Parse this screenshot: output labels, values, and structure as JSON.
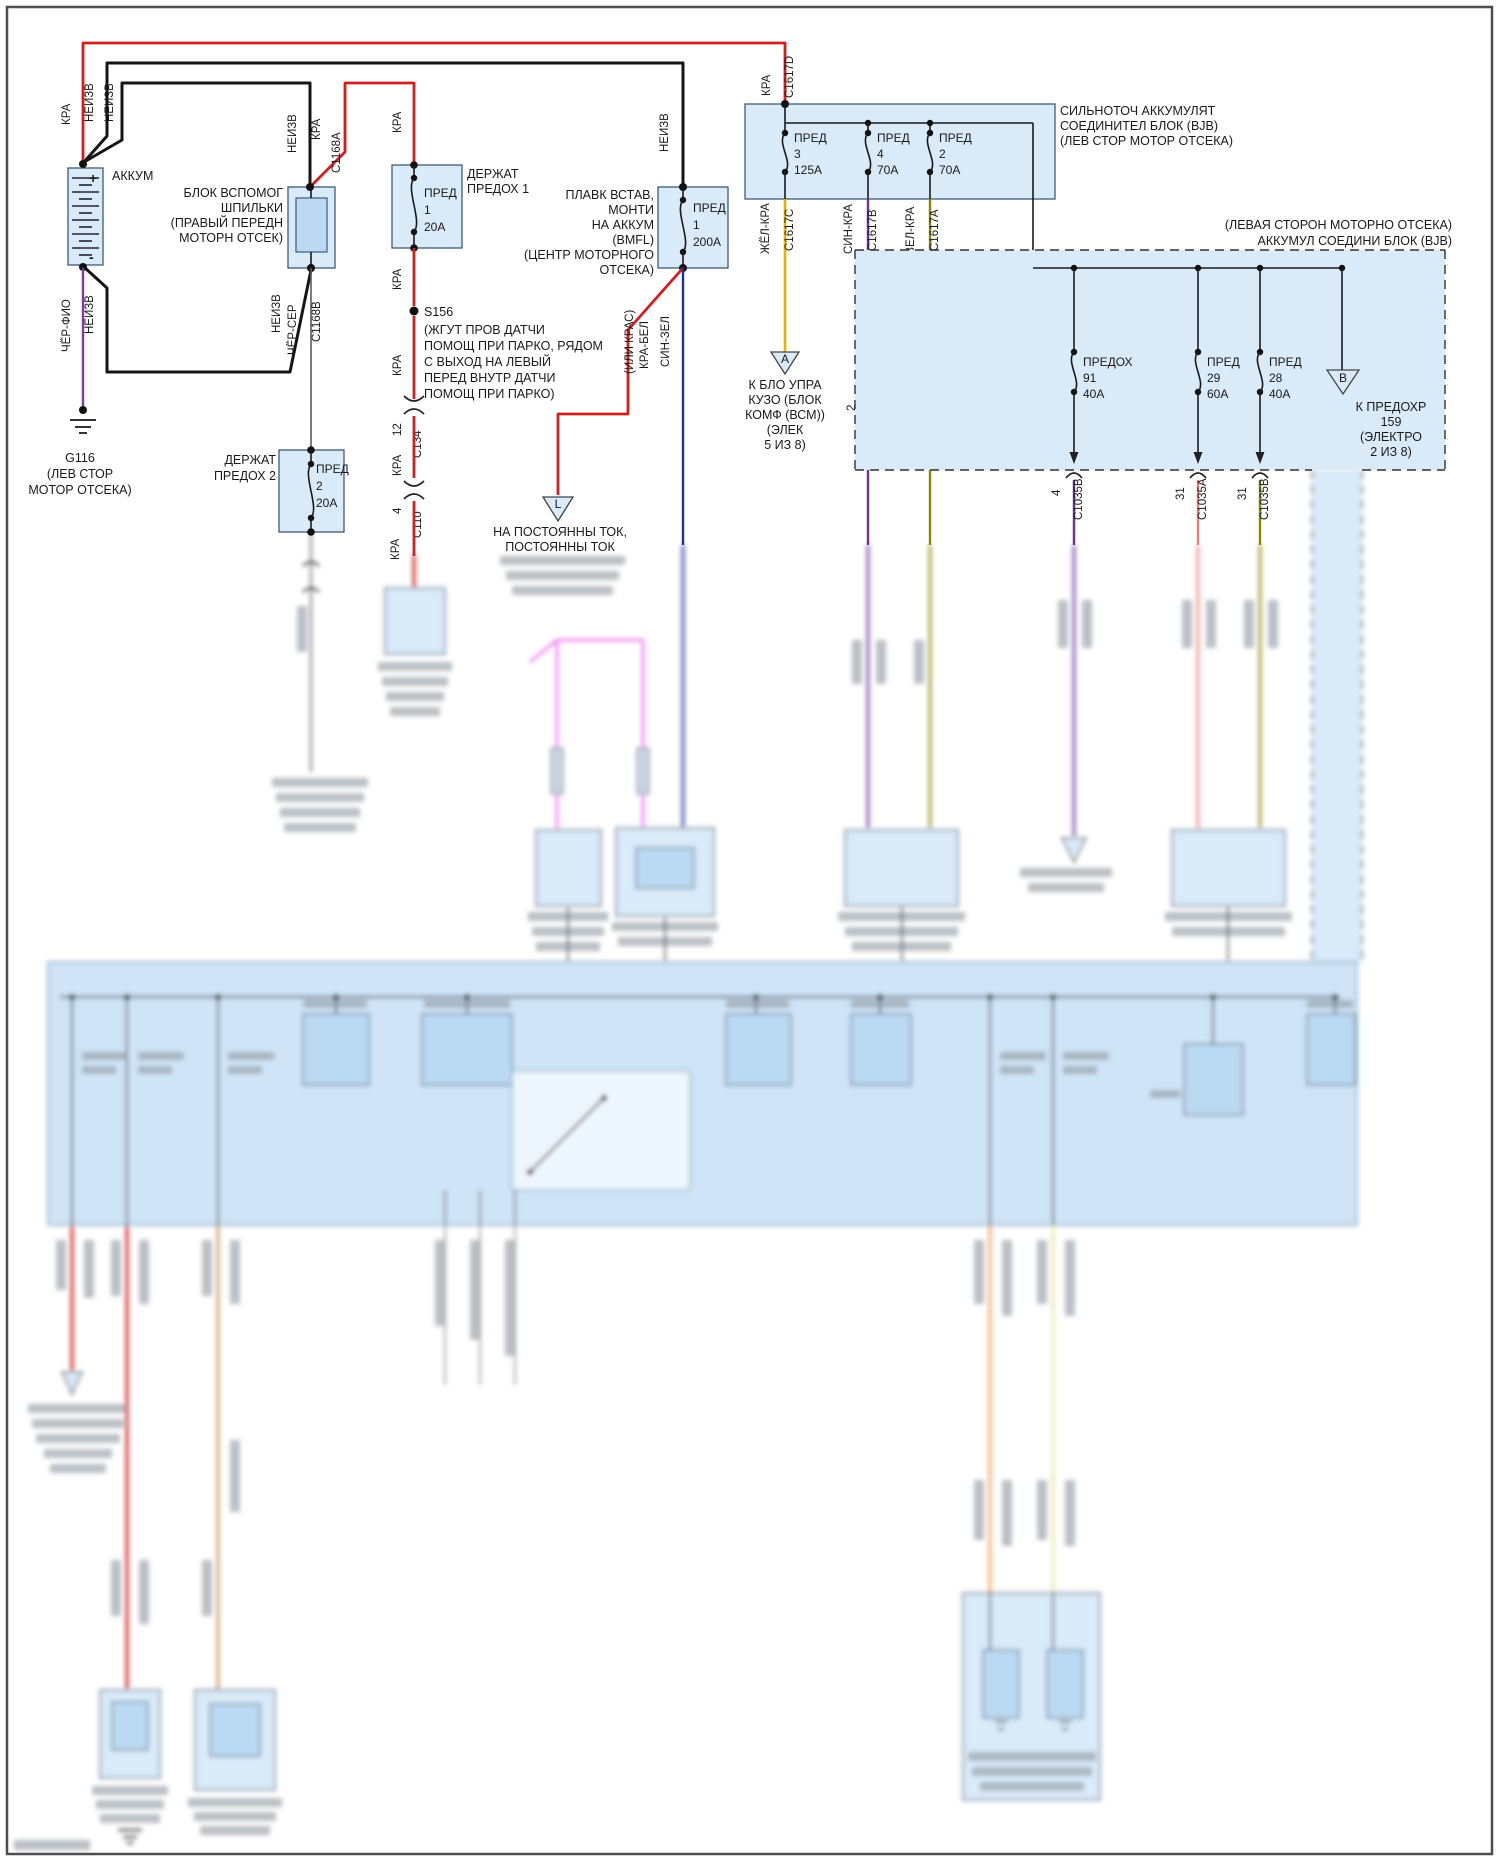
{
  "colors": {
    "wire_red": "#cf1f1f",
    "wire_black": "#141414",
    "wire_violet_black": "#7b3fa0",
    "wire_grey": "#5c5c5c",
    "wire_yellow": "#e2b400",
    "wire_blue_red": "#6a2fa0",
    "wire_green_red": "#8a8a00",
    "wire_blue_green": "#1f2fa0",
    "wire_magenta": "#ee6fee",
    "box_fill": "#d9eaf8",
    "box_border": "#3d5a78",
    "panel_fill": "#cfe4f6"
  },
  "battery": {
    "label": "АККУМ",
    "plus": "+",
    "minus": "-",
    "wires_pos": {
      "w1": "КРА",
      "w2": "НЕИЗВ",
      "w3": "НЕИЗВ"
    },
    "wires_neg": {
      "w1": "ЧЁР-ФИО",
      "w2": "НЕИЗВ"
    }
  },
  "ground_g116": {
    "id": "G116",
    "line1": "(ЛЕВ СТОР",
    "line2": "МОТОР ОТСЕКА)"
  },
  "stud_block": {
    "line1": "БЛОК ВСПОМОГ",
    "line2": "ШПИЛЬКИ",
    "line3": "(ПРАВЫЙ ПЕРЕДН",
    "line4": "МОТОРН ОТСЕК)",
    "top": {
      "wire": "НЕИЗВ",
      "wire2": "КРА",
      "conn": "C1168A"
    },
    "bottom": {
      "wire": "НЕИЗВ",
      "wire2": "ЧЁР-СЕР",
      "conn": "C1168B"
    }
  },
  "fuse_holder1": {
    "title1": "ДЕРЖАТ",
    "title2": "ПРЕДОХ 1",
    "fuse_name": "ПРЕД",
    "fuse_num": "1",
    "fuse_amp": "20А",
    "wire_in": "КРА",
    "wire_out": "КРА"
  },
  "splice_s156": {
    "id": "S156",
    "line1": "(ЖГУТ ПРОВ ДАТЧИ",
    "line2": "ПОМОЩ ПРИ ПАРКО, РЯДОМ",
    "line3": "С ВЫХОД НА ЛЕВЫЙ",
    "line4": "ПЕРЕД ВНУТР ДАТЧИ",
    "line5": "ПОМОЩ ПРИ ПАРКО)",
    "wire_below": "КРА"
  },
  "conn_c134": {
    "pin": "12",
    "wire": "КРА",
    "name": "C134"
  },
  "conn_c110": {
    "pin": "4",
    "wire": "КРА",
    "name": "C110"
  },
  "fuse_holder2": {
    "title1": "ДЕРЖАТ",
    "title2": "ПРЕДОХ 2",
    "fuse_name": "ПРЕД",
    "fuse_num": "2",
    "fuse_amp": "20А"
  },
  "bmfl": {
    "line1": "ПЛАВК ВСТАВ,",
    "line2": "МОНТИ",
    "line3": "НА АККУМ",
    "line4": "(BMFL)",
    "line5": "(ЦЕНТР МОТОРНОГО",
    "line6": "ОТСЕКА)",
    "wire_in": "НЕИЗВ",
    "fuse_name": "ПРЕД",
    "fuse_num": "1",
    "fuse_amp": "200А",
    "out_red1": "(ИЛИ КРАС)",
    "out_red2": "КРА-БЕЛ",
    "out_blue": "СИН-ЗЕЛ"
  },
  "ref_l": {
    "letter": "L",
    "line1": "НА ПОСТОЯННЫ ТОК,",
    "line2": "ПОСТОЯННЫ ТОК"
  },
  "bjb_main": {
    "wire_in": "КРА",
    "conn_in": "C1617D",
    "title1": "СИЛЬНОТОЧ АККУМУЛЯТ",
    "title2": "СОЕДИНИТЕЛ БЛОК (BJB)",
    "title3": "(ЛЕВ СТОР МОТОР ОТСЕКА)",
    "fuse3": {
      "name": "ПРЕД",
      "num": "3",
      "amp": "125А",
      "wire": "ЖЁЛ-КРА",
      "conn": "C1617C"
    },
    "fuse4": {
      "name": "ПРЕД",
      "num": "4",
      "amp": "70А",
      "wire": "СИН-КРА",
      "conn": "C1617B"
    },
    "fuse2": {
      "name": "ПРЕД",
      "num": "2",
      "amp": "70А",
      "wire": "ЗЕЛ-КРА",
      "conn": "C1617A"
    }
  },
  "ref_a": {
    "letter": "А",
    "line1": "К БЛО УПРА",
    "line2": "КУЗО (БЛОК",
    "line3": "КОМФ (ВСМ))",
    "line4": "(ЭЛЕК",
    "line5": "5 ИЗ 8)"
  },
  "conn_c237": {
    "pin_a": "2",
    "pin_b": "1",
    "name": "C237"
  },
  "bjb_aux": {
    "title1": "(ЛЕВАЯ СТОРОН МОТОРНО ОТСЕКА)",
    "title2": "АККУМУЛ СОЕДИНИ БЛОК (BJB)",
    "fuse91": {
      "name": "ПРЕДОХ",
      "num": "91",
      "amp": "40А",
      "pin": "4",
      "conn": "C1035B"
    },
    "fuse29": {
      "name": "ПРЕД",
      "num": "29",
      "amp": "60А",
      "pin": "31",
      "conn": "C1035A"
    },
    "fuse28": {
      "name": "ПРЕД",
      "num": "28",
      "amp": "40А",
      "pin": "31",
      "conn": "C1035B"
    },
    "ref_b": {
      "letter": "В",
      "line1": "К ПРЕДОХР",
      "line2": "159",
      "line3": "(ЭЛЕКТРО",
      "line4": "2 ИЗ 8)"
    }
  }
}
